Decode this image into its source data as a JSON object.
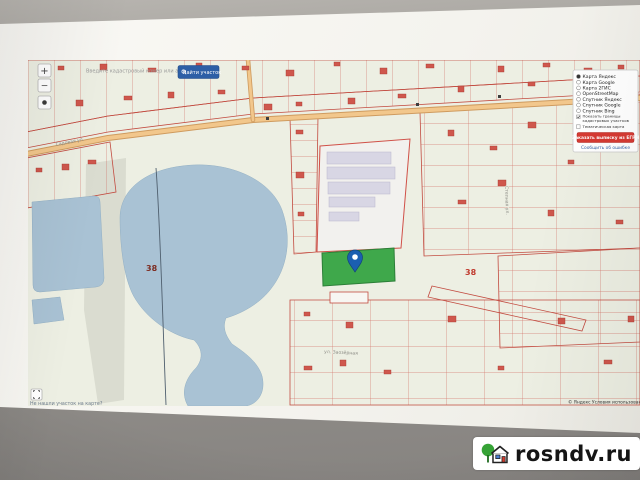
{
  "watermark": {
    "site": "rosndv.ru"
  },
  "controls": {
    "zoom_in": "+",
    "zoom_out": "−"
  },
  "search": {
    "hint": "Введите кадастровый номер или адрес",
    "find_button": "Найти участок"
  },
  "legend": {
    "layers": [
      "Карта Яндекс",
      "Карта Google",
      "Карта 2ГИС",
      "OpenStreetMap",
      "Спутник Яндекс",
      "Спутник Google",
      "Спутник Bing"
    ],
    "selected_layer": "Карта Яндекс",
    "checkbox1_line1": "Показать границы",
    "checkbox1_line2": "кадастровых участков",
    "checkbox2": "Тематическая карта",
    "order_button": "Заказать выписку из ЕГРН",
    "error_link": "Сообщить об ошибке"
  },
  "map": {
    "quarter_number_left": "38",
    "quarter_number_right": "38",
    "street_main": "Садовая ул.",
    "street_bottom": "ул. Заозёрная",
    "street_right": "Степная ул.",
    "not_found_link": "Не нашли участок на карте?",
    "attribution": "© Яндекс Условия использования"
  },
  "colors": {
    "parcel_line": "#cc5247",
    "lake": "#a9c2d4",
    "selected_parcel": "#3fa84b",
    "pin": "#1b5fb0",
    "accent_button": "#d63a33",
    "find_button": "#2d5fa6"
  }
}
